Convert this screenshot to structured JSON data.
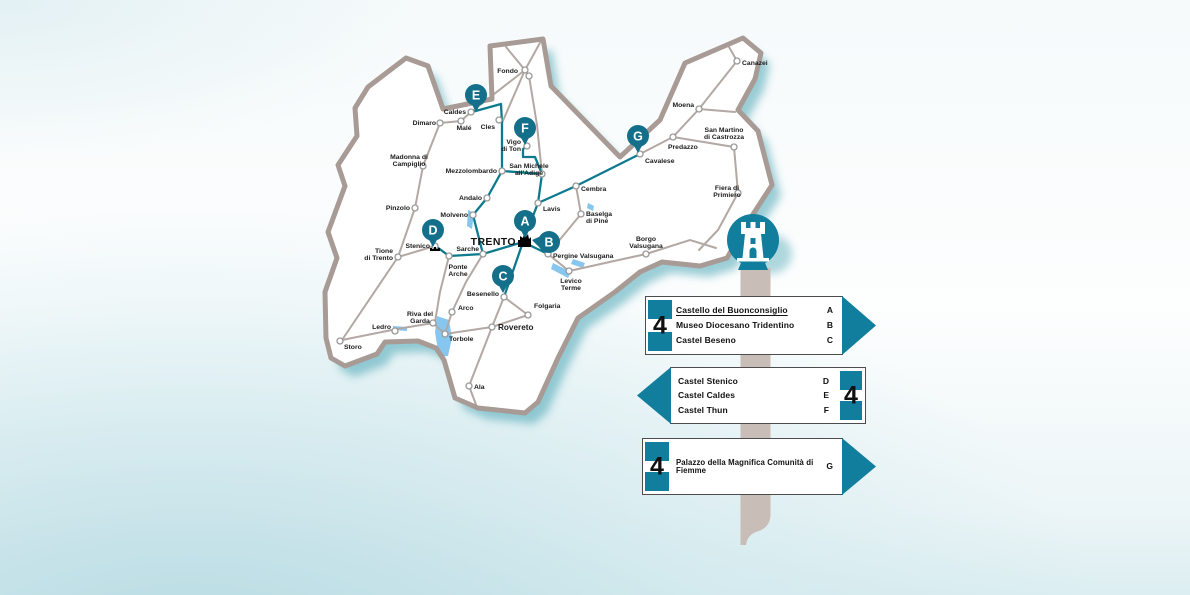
{
  "colors": {
    "sign_teal": "#117e9e",
    "pin_teal": "#14708a",
    "route_teal": "#0e7a8e",
    "road": "#b3a8a3",
    "border": "#a89b96",
    "lake": "#87c7ef",
    "post": "#c9bdb7",
    "shadow_teal": "#3a9dae",
    "text_dark": "#1c1c1c"
  },
  "map": {
    "capital": {
      "name": "TRENTO",
      "x": 525,
      "y": 241
    },
    "outline": [
      [
        490,
        46
      ],
      [
        543,
        39
      ],
      [
        551,
        86
      ],
      [
        620,
        157
      ],
      [
        660,
        120
      ],
      [
        685,
        63
      ],
      [
        743,
        38
      ],
      [
        761,
        53
      ],
      [
        755,
        79
      ],
      [
        738,
        110
      ],
      [
        758,
        131
      ],
      [
        772,
        185
      ],
      [
        748,
        222
      ],
      [
        727,
        258
      ],
      [
        700,
        266
      ],
      [
        662,
        262
      ],
      [
        640,
        272
      ],
      [
        615,
        292
      ],
      [
        578,
        318
      ],
      [
        558,
        358
      ],
      [
        538,
        402
      ],
      [
        525,
        413
      ],
      [
        478,
        408
      ],
      [
        455,
        398
      ],
      [
        444,
        360
      ],
      [
        436,
        348
      ],
      [
        418,
        341
      ],
      [
        385,
        342
      ],
      [
        377,
        354
      ],
      [
        345,
        366
      ],
      [
        331,
        358
      ],
      [
        326,
        338
      ],
      [
        325,
        292
      ],
      [
        337,
        258
      ],
      [
        328,
        232
      ],
      [
        345,
        186
      ],
      [
        338,
        165
      ],
      [
        357,
        136
      ],
      [
        355,
        108
      ],
      [
        368,
        87
      ],
      [
        406,
        58
      ],
      [
        428,
        66
      ],
      [
        443,
        109
      ],
      [
        492,
        99
      ]
    ],
    "roads": [
      [
        [
          342,
          340
        ],
        [
          397,
          329
        ],
        [
          433,
          323
        ]
      ],
      [
        [
          342,
          340
        ],
        [
          398,
          257
        ]
      ],
      [
        [
          398,
          257
        ],
        [
          415,
          208
        ],
        [
          423,
          166
        ],
        [
          440,
          123
        ]
      ],
      [
        [
          440,
          123
        ],
        [
          461,
          121
        ],
        [
          471,
          112
        ]
      ],
      [
        [
          471,
          112
        ],
        [
          525,
          70
        ]
      ],
      [
        [
          502,
          123
        ],
        [
          525,
          70
        ]
      ],
      [
        [
          525,
          70
        ],
        [
          529,
          76
        ],
        [
          537,
          125
        ],
        [
          542,
          174
        ]
      ],
      [
        [
          506,
          47
        ],
        [
          525,
          70
        ]
      ],
      [
        [
          541,
          41
        ],
        [
          525,
          70
        ]
      ],
      [
        [
          398,
          257
        ],
        [
          435,
          246
        ]
      ],
      [
        [
          449,
          256
        ],
        [
          440,
          292
        ],
        [
          435,
          322
        ]
      ],
      [
        [
          483,
          254
        ],
        [
          466,
          282
        ],
        [
          452,
          312
        ]
      ],
      [
        [
          452,
          312
        ],
        [
          445,
          334
        ]
      ],
      [
        [
          433,
          323
        ],
        [
          445,
          334
        ],
        [
          492,
          327
        ]
      ],
      [
        [
          492,
          327
        ],
        [
          469,
          386
        ],
        [
          478,
          410
        ]
      ],
      [
        [
          492,
          327
        ],
        [
          504,
          297
        ]
      ],
      [
        [
          504,
          297
        ],
        [
          528,
          315
        ]
      ],
      [
        [
          492,
          327
        ],
        [
          528,
          315
        ]
      ],
      [
        [
          548,
          254
        ],
        [
          569,
          271
        ],
        [
          646,
          254
        ]
      ],
      [
        [
          646,
          254
        ],
        [
          690,
          240
        ],
        [
          716,
          248
        ]
      ],
      [
        [
          548,
          254
        ],
        [
          581,
          214
        ],
        [
          576,
          186
        ]
      ],
      [
        [
          640,
          154
        ],
        [
          673,
          137
        ],
        [
          699,
          109
        ],
        [
          737,
          61
        ]
      ],
      [
        [
          673,
          137
        ],
        [
          734,
          147
        ],
        [
          738,
          193
        ]
      ],
      [
        [
          738,
          193
        ],
        [
          718,
          230
        ],
        [
          699,
          250
        ]
      ],
      [
        [
          699,
          109
        ],
        [
          735,
          112
        ]
      ],
      [
        [
          737,
          61
        ],
        [
          729,
          47
        ]
      ]
    ],
    "routes": [
      [
        [
          523,
          242
        ],
        [
          483,
          254
        ],
        [
          449,
          256
        ],
        [
          437,
          247
        ]
      ],
      [
        [
          483,
          254
        ],
        [
          473,
          215
        ],
        [
          487,
          198
        ],
        [
          502,
          171
        ]
      ],
      [
        [
          502,
          171
        ],
        [
          502,
          123
        ],
        [
          501,
          104
        ],
        [
          472,
          112
        ]
      ],
      [
        [
          502,
          171
        ],
        [
          542,
          174
        ]
      ],
      [
        [
          542,
          174
        ],
        [
          538,
          203
        ],
        [
          523,
          242
        ]
      ],
      [
        [
          542,
          174
        ],
        [
          535,
          157
        ],
        [
          523,
          157
        ],
        [
          523,
          149
        ],
        [
          527,
          146
        ]
      ],
      [
        [
          538,
          203
        ],
        [
          576,
          186
        ],
        [
          640,
          154
        ]
      ],
      [
        [
          523,
          242
        ],
        [
          504,
          297
        ]
      ],
      [
        [
          523,
          242
        ],
        [
          548,
          254
        ]
      ]
    ],
    "lakes": [
      [
        [
          437,
          316
        ],
        [
          449,
          320
        ],
        [
          452,
          338
        ],
        [
          448,
          356
        ],
        [
          439,
          357
        ],
        [
          435,
          332
        ]
      ],
      [
        [
          393,
          326
        ],
        [
          407,
          327
        ],
        [
          407,
          331
        ],
        [
          393,
          330
        ]
      ],
      [
        [
          468,
          210
        ],
        [
          474,
          213
        ],
        [
          472,
          229
        ],
        [
          467,
          226
        ]
      ],
      [
        [
          553,
          263
        ],
        [
          571,
          272
        ],
        [
          568,
          278
        ],
        [
          551,
          269
        ]
      ],
      [
        [
          573,
          259
        ],
        [
          585,
          263
        ],
        [
          583,
          268
        ],
        [
          571,
          264
        ]
      ],
      [
        [
          588,
          203
        ],
        [
          594,
          206
        ],
        [
          593,
          211
        ],
        [
          587,
          208
        ]
      ]
    ],
    "extra_nodes": [
      [
        529,
        76
      ]
    ],
    "towns": [
      {
        "name": "Fondo",
        "x": 525,
        "y": 70,
        "anchor": "end",
        "lx": 518,
        "ly": 73,
        "lines": [
          "Fondo"
        ]
      },
      {
        "name": "Caldes",
        "x": 471,
        "y": 112,
        "anchor": "end",
        "lx": 466,
        "ly": 114,
        "lines": [
          "Caldes"
        ]
      },
      {
        "name": "Malé",
        "x": 461,
        "y": 121,
        "anchor": "middle",
        "lx": 464,
        "ly": 130,
        "lines": [
          "Malé"
        ]
      },
      {
        "name": "Dimaro",
        "x": 440,
        "y": 123,
        "anchor": "end",
        "lx": 436,
        "ly": 125,
        "lines": [
          "Dimaro"
        ]
      },
      {
        "name": "Cles",
        "x": 499,
        "y": 120,
        "anchor": "end",
        "lx": 495,
        "ly": 129,
        "lines": [
          "Cles"
        ]
      },
      {
        "name": "Vigo di Ton",
        "x": 527,
        "y": 146,
        "anchor": "end",
        "lx": 521,
        "ly": 144,
        "lines": [
          "Vigo",
          "di Ton"
        ]
      },
      {
        "name": "Madonna di Campiglio",
        "x": 423,
        "y": 166,
        "anchor": "middle",
        "lx": 409,
        "ly": 159,
        "lines": [
          "Madonna di",
          "Campiglio"
        ]
      },
      {
        "name": "Mezzolombardo",
        "x": 502,
        "y": 171,
        "anchor": "end",
        "lx": 497,
        "ly": 173,
        "lines": [
          "Mezzolombardo"
        ]
      },
      {
        "name": "San Michele all'Adige",
        "x": 542,
        "y": 174,
        "anchor": "middle",
        "lx": 529,
        "ly": 168,
        "lines": [
          "San Michele",
          "all'Adige"
        ]
      },
      {
        "name": "Pinzolo",
        "x": 415,
        "y": 208,
        "anchor": "end",
        "lx": 410,
        "ly": 210,
        "lines": [
          "Pinzolo"
        ]
      },
      {
        "name": "Andalo",
        "x": 487,
        "y": 198,
        "anchor": "end",
        "lx": 482,
        "ly": 200,
        "lines": [
          "Andalo"
        ]
      },
      {
        "name": "Molveno",
        "x": 473,
        "y": 215,
        "anchor": "end",
        "lx": 468,
        "ly": 217,
        "lines": [
          "Molveno"
        ]
      },
      {
        "name": "Lavis",
        "x": 538,
        "y": 203,
        "anchor": "start",
        "lx": 543,
        "ly": 211,
        "lines": [
          "Lavis"
        ]
      },
      {
        "name": "Cembra",
        "x": 576,
        "y": 186,
        "anchor": "start",
        "lx": 581,
        "ly": 191,
        "lines": [
          "Cembra"
        ]
      },
      {
        "name": "Baselga di Piné",
        "x": 581,
        "y": 214,
        "anchor": "start",
        "lx": 586,
        "ly": 216,
        "lines": [
          "Baselga",
          "di Piné"
        ]
      },
      {
        "name": "Stenico",
        "x": 435,
        "y": 246,
        "anchor": "end",
        "lx": 430,
        "ly": 248,
        "lines": [
          "Stenico"
        ]
      },
      {
        "name": "Sarche",
        "x": 483,
        "y": 254,
        "anchor": "end",
        "lx": 479,
        "ly": 251,
        "lines": [
          "Sarche"
        ]
      },
      {
        "name": "Tione di Trento",
        "x": 398,
        "y": 257,
        "anchor": "end",
        "lx": 393,
        "ly": 253,
        "lines": [
          "Tione",
          "di Trento"
        ]
      },
      {
        "name": "Ponte Arche",
        "x": 449,
        "y": 256,
        "anchor": "middle",
        "lx": 458,
        "ly": 269,
        "lines": [
          "Ponte",
          "Arche"
        ]
      },
      {
        "name": "Pergine Valsugana",
        "x": 548,
        "y": 254,
        "anchor": "start",
        "lx": 553,
        "ly": 258,
        "lines": [
          "Pergine Valsugana"
        ]
      },
      {
        "name": "Borgo Valsugana",
        "x": 646,
        "y": 254,
        "anchor": "middle",
        "lx": 646,
        "ly": 241,
        "lines": [
          "Borgo",
          "Valsugana"
        ]
      },
      {
        "name": "Levico Terme",
        "x": 569,
        "y": 271,
        "anchor": "middle",
        "lx": 571,
        "ly": 283,
        "lines": [
          "Levico",
          "Terme"
        ]
      },
      {
        "name": "Besenello",
        "x": 504,
        "y": 297,
        "anchor": "end",
        "lx": 499,
        "ly": 296,
        "lines": [
          "Besenello"
        ]
      },
      {
        "name": "Folgaria",
        "x": 528,
        "y": 315,
        "anchor": "start",
        "lx": 534,
        "ly": 308,
        "lines": [
          "Folgaria"
        ]
      },
      {
        "name": "Arco",
        "x": 452,
        "y": 312,
        "anchor": "start",
        "lx": 458,
        "ly": 310,
        "lines": [
          "Arco"
        ]
      },
      {
        "name": "Riva del Garda",
        "x": 433,
        "y": 323,
        "anchor": "middle",
        "lx": 420,
        "ly": 316,
        "lines": [
          "Riva del",
          "Garda"
        ]
      },
      {
        "name": "Ledro",
        "x": 395,
        "y": 331,
        "anchor": "end",
        "lx": 391,
        "ly": 329,
        "lines": [
          "Ledro"
        ]
      },
      {
        "name": "Storo",
        "x": 340,
        "y": 341,
        "anchor": "start",
        "lx": 344,
        "ly": 349,
        "lines": [
          "Storo"
        ]
      },
      {
        "name": "Torbole",
        "x": 445,
        "y": 334,
        "anchor": "start",
        "lx": 449,
        "ly": 341,
        "lines": [
          "Torbole"
        ]
      },
      {
        "name": "Rovereto",
        "x": 492,
        "y": 327,
        "anchor": "start",
        "lx": 498,
        "ly": 330,
        "big": true,
        "lines": [
          "Rovereto"
        ]
      },
      {
        "name": "Ala",
        "x": 469,
        "y": 386,
        "anchor": "start",
        "lx": 474,
        "ly": 389,
        "lines": [
          "Ala"
        ]
      },
      {
        "name": "Cavalese",
        "x": 640,
        "y": 154,
        "anchor": "start",
        "lx": 645,
        "ly": 163,
        "lines": [
          "Cavalese"
        ]
      },
      {
        "name": "Predazzo",
        "x": 673,
        "y": 137,
        "anchor": "start",
        "lx": 668,
        "ly": 149,
        "lines": [
          "Predazzo"
        ]
      },
      {
        "name": "Moena",
        "x": 699,
        "y": 109,
        "anchor": "end",
        "lx": 694,
        "ly": 107,
        "lines": [
          "Moena"
        ]
      },
      {
        "name": "Canazei",
        "x": 737,
        "y": 61,
        "anchor": "start",
        "lx": 742,
        "ly": 65,
        "lines": [
          "Canazei"
        ]
      },
      {
        "name": "San Martino di Castrozza",
        "x": 734,
        "y": 147,
        "anchor": "middle",
        "lx": 724,
        "ly": 132,
        "lines": [
          "San Martino",
          "di Castrozza"
        ]
      },
      {
        "name": "Fiera di Primiero",
        "x": 738,
        "y": 193,
        "anchor": "middle",
        "lx": 727,
        "ly": 190,
        "lines": [
          "Fiera di",
          "Primiero"
        ]
      }
    ],
    "pins": [
      {
        "id": "A",
        "x": 525,
        "y": 221,
        "dir": "down"
      },
      {
        "id": "B",
        "x": 549,
        "y": 242,
        "dir": "left"
      },
      {
        "id": "C",
        "x": 503,
        "y": 276,
        "dir": "down"
      },
      {
        "id": "D",
        "x": 433,
        "y": 230,
        "dir": "down"
      },
      {
        "id": "E",
        "x": 476,
        "y": 95,
        "dir": "down"
      },
      {
        "id": "F",
        "x": 525,
        "y": 128,
        "dir": "down"
      },
      {
        "id": "G",
        "x": 638,
        "y": 136,
        "dir": "down"
      }
    ]
  },
  "signpost": {
    "icon": "castle-tower"
  },
  "signs": [
    {
      "number": "4",
      "arrow": "right",
      "entries": [
        {
          "label": "Castello del Buonconsiglio",
          "letter": "A",
          "underline": true
        },
        {
          "label": "Museo Diocesano Tridentino",
          "letter": "B"
        },
        {
          "label": "Castel Beseno",
          "letter": "C"
        }
      ]
    },
    {
      "number": "4",
      "arrow": "left",
      "entries": [
        {
          "label": "Castel Stenico",
          "letter": "D"
        },
        {
          "label": "Castel Caldes",
          "letter": "E"
        },
        {
          "label": "Castel Thun",
          "letter": "F"
        }
      ]
    },
    {
      "number": "4",
      "arrow": "right",
      "entries": [
        {
          "label": "Palazzo della Magnifica Comunità di Fiemme",
          "letter": "G"
        }
      ]
    }
  ]
}
